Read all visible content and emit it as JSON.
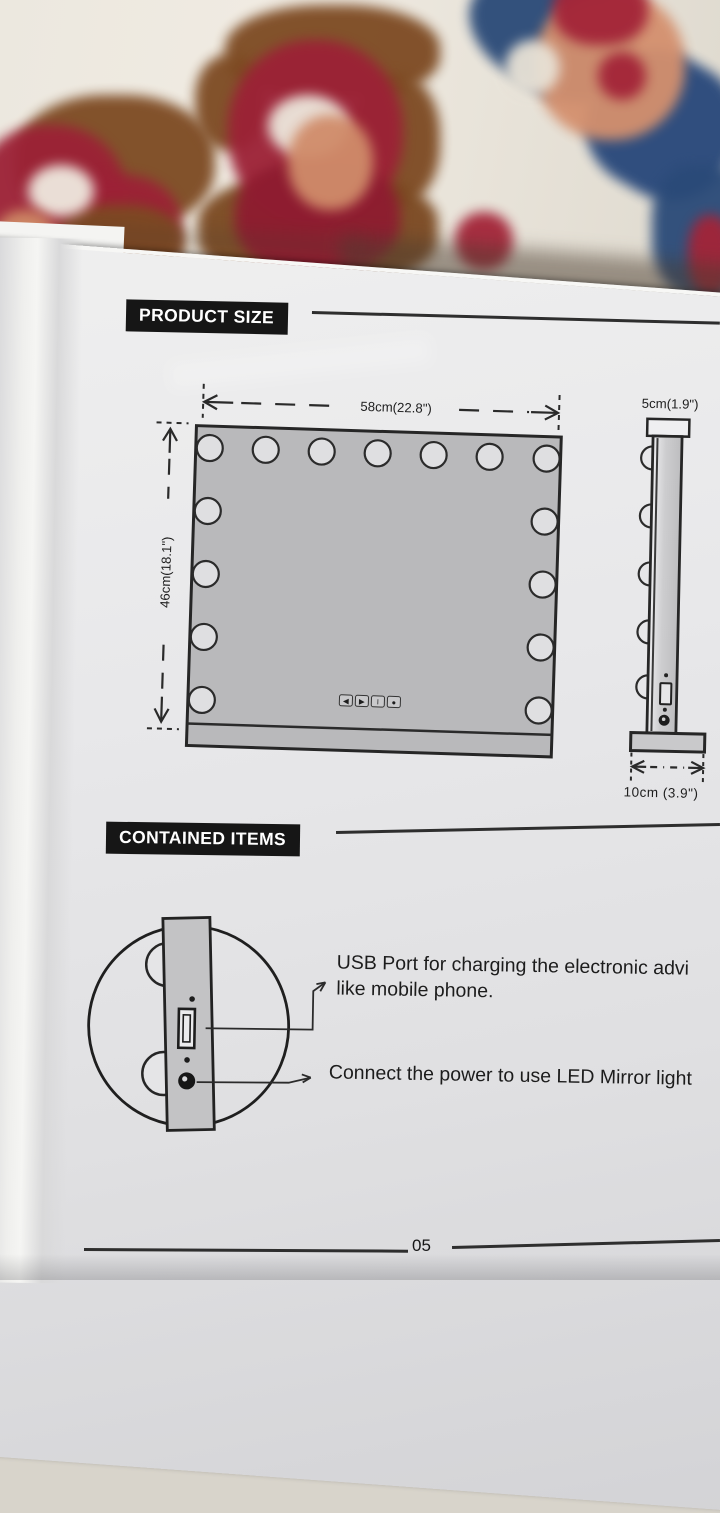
{
  "page": {
    "number": "05"
  },
  "product_size": {
    "heading": "PRODUCT SIZE",
    "front_view": {
      "width_label": "58cm(22.8\")",
      "height_label": "46cm(18.1\")",
      "controls": [
        {
          "name": "prev-arrow-icon",
          "glyph": "◀"
        },
        {
          "name": "next-arrow-icon",
          "glyph": "▶"
        },
        {
          "name": "power-bar-icon",
          "glyph": "I"
        },
        {
          "name": "dot-icon",
          "glyph": "●"
        }
      ]
    },
    "side_view": {
      "top_label": "5cm(1.9\")",
      "bottom_label": "10cm (3.9\")"
    }
  },
  "contained_items": {
    "heading": "CONTAINED ITEMS",
    "usb_note_line1": "USB Port for charging the electronic advi",
    "usb_note_line2": "like mobile phone.",
    "power_note": "Connect the power to use LED Mirror light"
  },
  "colors": {
    "header_bg": "#161616",
    "header_text": "#ffffff",
    "mirror_fill": "#b9b9bb",
    "diagram_line": "#262626",
    "page_bg": "#e6e6e8",
    "carpet_red": "#9c2136",
    "carpet_brown": "#7d4a22",
    "carpet_salmon": "#d08c6a",
    "carpet_navy": "#2a4a78"
  }
}
